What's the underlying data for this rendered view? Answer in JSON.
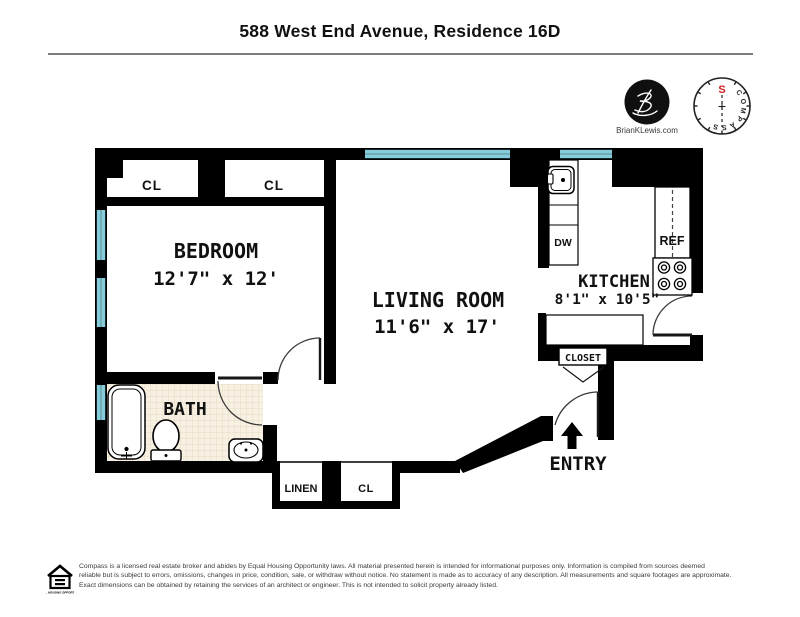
{
  "title": "588 West End Avenue, Residence 16D",
  "branding": {
    "logo_url_text": "BrianKLewis.com",
    "compass_word": "COMPASS",
    "compass_letters": [
      "C",
      "O",
      "M",
      "P",
      "A",
      "S",
      "S"
    ],
    "compass_north_label": "S"
  },
  "plan": {
    "bedroom": {
      "label": "BEDROOM",
      "dims": "12'7\" x 12'"
    },
    "living_room": {
      "label": "LIVING ROOM",
      "dims": "11'6\" x 17'"
    },
    "kitchen": {
      "label": "KITCHEN",
      "dims": "8'1\" x 10'5\""
    },
    "bath": {
      "label": "BATH"
    },
    "entry": {
      "label": "ENTRY"
    },
    "foyer_closet": {
      "label": "CLOSET"
    },
    "linen_closet": {
      "label": "LINEN"
    },
    "closet_top_left": {
      "label": "CL"
    },
    "closet_top_right": {
      "label": "CL"
    },
    "closet_bottom": {
      "label": "CL"
    },
    "refrigerator": {
      "label": "REF"
    },
    "dishwasher": {
      "label": "DW"
    }
  },
  "footer": {
    "eho_label": "EQUAL HOUSING OPPORTUNITY",
    "line1": "Compass is a licensed real estate broker and abides by Equal Housing Opportunity laws. All material presented herein is intended for informational purposes only. Information is compiled from sources deemed",
    "line2": "reliable but is subject to errors, omissions, changes in price, condition, sale, or withdraw without notice. No statement is made as to accuracy of any description. All measurements and square footages are approximate.",
    "line3": "Exact dimensions can be obtained by retaining the services of an architect or engineer. This is not intended to solicit property already listed."
  },
  "colors": {
    "wall": "#000000",
    "window": "#85ccda",
    "tile_floor": "#f8f1e3",
    "compass_north": "#cc2222"
  }
}
